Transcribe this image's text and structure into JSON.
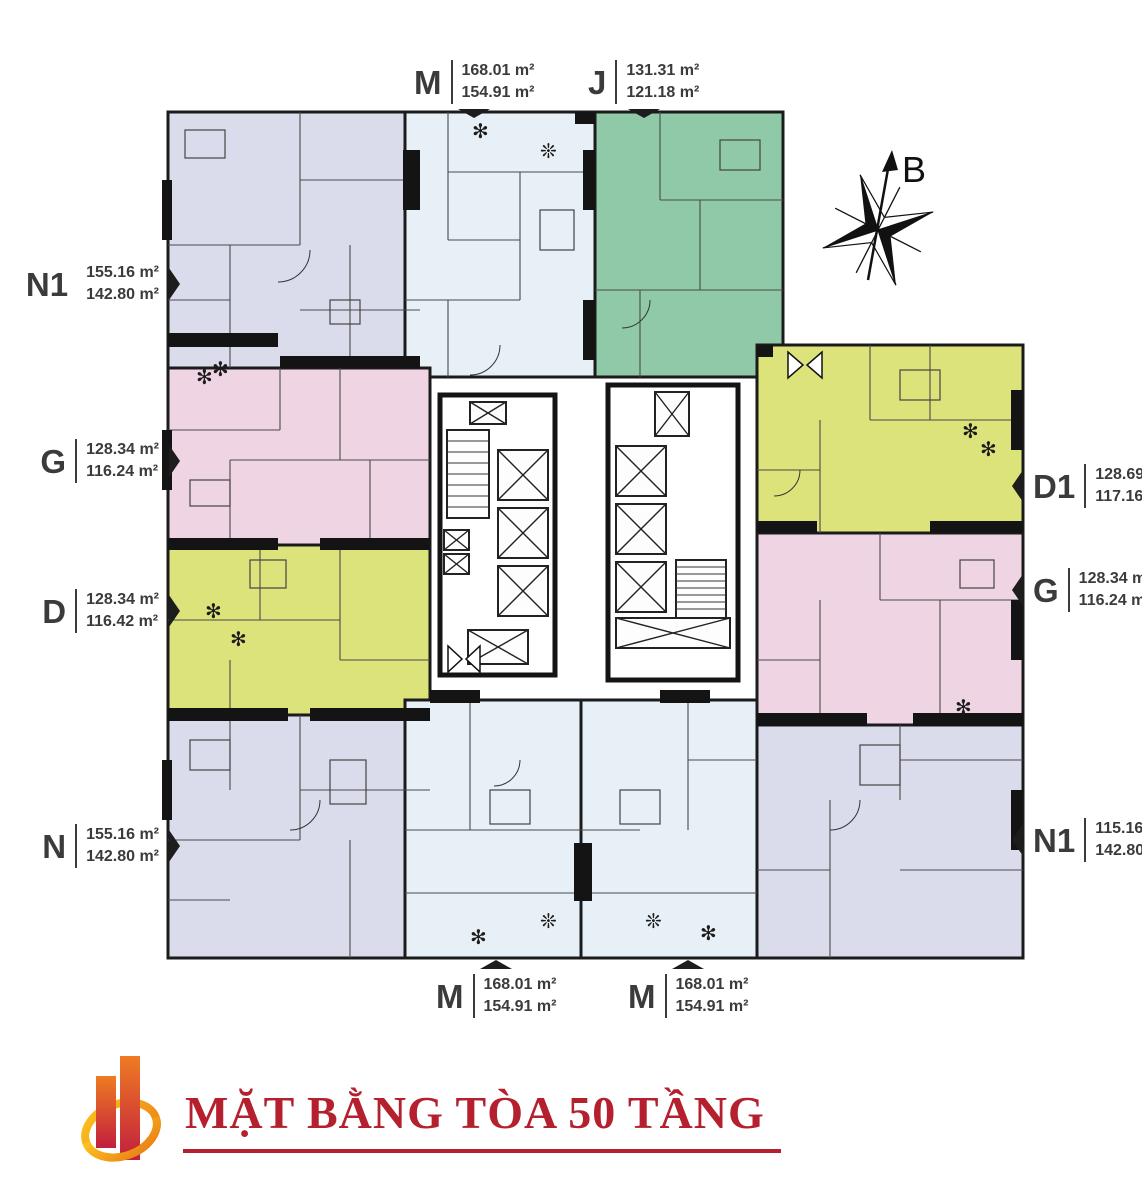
{
  "title": {
    "text": "MẶT BẰNG TÒA 50 TẦNG",
    "color": "#b5202e"
  },
  "compass": {
    "label": "B"
  },
  "icons": {
    "plant": "✻",
    "tree": "❊"
  },
  "colors": {
    "lavender": "#dadcec",
    "blue": "#e7f0f7",
    "green": "#8fc9a7",
    "pink": "#efd4e4",
    "lime": "#dde37b",
    "wall": "#1a1a1a",
    "title_red": "#b5202e",
    "logo_red": "#c21f3d",
    "logo_orange": "#f5a81c",
    "white": "#ffffff"
  },
  "units": [
    {
      "id": "N1",
      "position": "top-left",
      "color": "lavender"
    },
    {
      "id": "M",
      "position": "top-center",
      "color": "blue"
    },
    {
      "id": "J",
      "position": "top-right",
      "color": "green"
    },
    {
      "id": "G",
      "position": "left",
      "color": "pink"
    },
    {
      "id": "D",
      "position": "left-lower",
      "color": "lime"
    },
    {
      "id": "N",
      "position": "bottom-left",
      "color": "lavender"
    },
    {
      "id": "M",
      "position": "bottom-center-left",
      "color": "blue"
    },
    {
      "id": "M",
      "position": "bottom-center-right",
      "color": "blue"
    },
    {
      "id": "N1",
      "position": "bottom-right",
      "color": "lavender"
    },
    {
      "id": "G",
      "position": "right",
      "color": "pink"
    },
    {
      "id": "D1",
      "position": "right-upper",
      "color": "lime"
    }
  ],
  "labels": [
    {
      "id": "M-top",
      "letter": "M",
      "area1": "168.01 m²",
      "area2": "154.91 m²"
    },
    {
      "id": "J-top",
      "letter": "J",
      "area1": "131.31 m²",
      "area2": "121.18 m²"
    },
    {
      "id": "N1-left",
      "letter": "N1",
      "area1": "155.16 m²",
      "area2": "142.80 m²"
    },
    {
      "id": "G-left",
      "letter": "G",
      "area1": "128.34 m²",
      "area2": "116.24 m²"
    },
    {
      "id": "D-left",
      "letter": "D",
      "area1": "128.34 m²",
      "area2": "116.42 m²"
    },
    {
      "id": "N-left",
      "letter": "N",
      "area1": "155.16 m²",
      "area2": "142.80 m²"
    },
    {
      "id": "D1-right",
      "letter": "D1",
      "area1": "128.69 m²",
      "area2": "117.16 m²"
    },
    {
      "id": "G-right",
      "letter": "G",
      "area1": "128.34 m²",
      "area2": "116.24 m²"
    },
    {
      "id": "N1-right",
      "letter": "N1",
      "area1": "115.16 m²",
      "area2": "142.80 m²"
    },
    {
      "id": "M-bottom-left",
      "letter": "M",
      "area1": "168.01 m²",
      "area2": "154.91 m²"
    },
    {
      "id": "M-bottom-right",
      "letter": "M",
      "area1": "168.01 m²",
      "area2": "154.91 m²"
    }
  ]
}
